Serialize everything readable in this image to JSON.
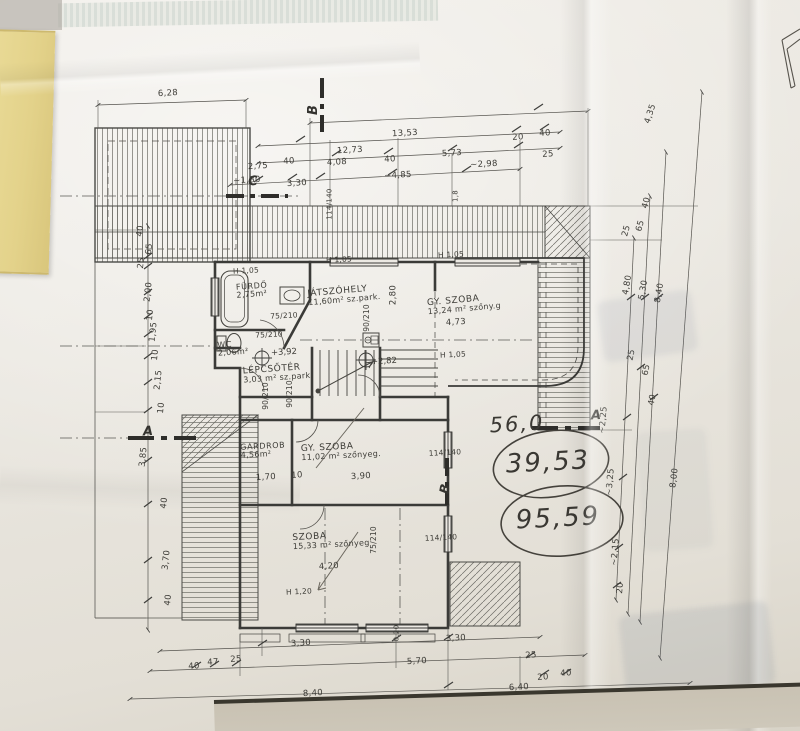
{
  "document": {
    "kind": "hand-drawn floor plan photo",
    "language": "Hungarian"
  },
  "colors": {
    "paper": "#ece9e3",
    "ink": "#3e3e3b",
    "pencil": "#55524c",
    "tape": "#e3d28b"
  },
  "plan": {
    "rooms": [
      {
        "name": "FÜRDŐ",
        "area": "2,75m²",
        "x": 252,
        "y": 291,
        "r": -4,
        "s": 8
      },
      {
        "name": "WC",
        "area": "2,06m²",
        "x": 233,
        "y": 349,
        "r": -4,
        "s": 8
      },
      {
        "name": "JÁTSZÓHELY",
        "area": "11,60m² sz.park.",
        "x": 344,
        "y": 296,
        "r": -5,
        "s": 9
      },
      {
        "name": "GY. SZOBA",
        "area": "13,24 m² szőny.g",
        "x": 464,
        "y": 305,
        "r": -5,
        "s": 9
      },
      {
        "name": "LÉPCSŐTÉR",
        "area": "3,03 m² sz.park.",
        "x": 278,
        "y": 374,
        "r": -4,
        "s": 9
      },
      {
        "name": "GARDROB",
        "area": "4,56m²",
        "x": 263,
        "y": 451,
        "r": -3,
        "s": 8
      },
      {
        "name": "GY. SZOBA",
        "area": "11,02 m² szőnyeg.",
        "x": 341,
        "y": 452,
        "r": -3,
        "s": 9
      },
      {
        "name": "SZOBA",
        "area": "15,33 m² szőnyeg",
        "x": 331,
        "y": 541,
        "r": -3,
        "s": 9
      }
    ],
    "levels": [
      {
        "t": "+3,92",
        "x": 284,
        "y": 353
      },
      {
        "t": "+2,82",
        "x": 384,
        "y": 362
      }
    ],
    "sections": [
      {
        "t": "C",
        "x": 253,
        "y": 182
      },
      {
        "t": "B",
        "x": 314,
        "y": 110,
        "r": -90
      },
      {
        "t": "A",
        "x": 148,
        "y": 432
      },
      {
        "t": "A",
        "x": 596,
        "y": 416
      },
      {
        "t": "B",
        "x": 446,
        "y": 489,
        "r": -80
      }
    ],
    "dimensions": [
      {
        "t": "6,28",
        "x": 168,
        "y": 94
      },
      {
        "t": "13,53",
        "x": 405,
        "y": 134
      },
      {
        "t": "12,73",
        "x": 350,
        "y": 151
      },
      {
        "t": "20",
        "x": 518,
        "y": 138
      },
      {
        "t": "40",
        "x": 545,
        "y": 134
      },
      {
        "t": "25",
        "x": 548,
        "y": 155
      },
      {
        "t": "5,73",
        "x": 452,
        "y": 154
      },
      {
        "t": "~2,98",
        "x": 484,
        "y": 165
      },
      {
        "t": "4,08",
        "x": 337,
        "y": 163
      },
      {
        "t": "40",
        "x": 390,
        "y": 160
      },
      {
        "t": "~4,85",
        "x": 398,
        "y": 176
      },
      {
        "t": "2,75",
        "x": 258,
        "y": 167
      },
      {
        "t": "40",
        "x": 289,
        "y": 162
      },
      {
        "t": "~1,80",
        "x": 247,
        "y": 181
      },
      {
        "t": "3,30",
        "x": 297,
        "y": 184
      },
      {
        "t": "114/140",
        "x": 330,
        "y": 204,
        "r": -90,
        "s": 7
      },
      {
        "t": "1,8",
        "x": 456,
        "y": 196,
        "r": -90,
        "s": 7
      },
      {
        "t": "40",
        "x": 141,
        "y": 231,
        "r": -84
      },
      {
        "t": "65",
        "x": 150,
        "y": 249,
        "r": -84
      },
      {
        "t": "25",
        "x": 142,
        "y": 263,
        "r": -84
      },
      {
        "t": "2,00",
        "x": 149,
        "y": 292,
        "r": -84
      },
      {
        "t": "10",
        "x": 151,
        "y": 315,
        "r": -84
      },
      {
        "t": "1,95",
        "x": 154,
        "y": 332,
        "r": -84
      },
      {
        "t": "10",
        "x": 156,
        "y": 355,
        "r": -84
      },
      {
        "t": "2,15",
        "x": 159,
        "y": 380,
        "r": -84
      },
      {
        "t": "10",
        "x": 162,
        "y": 408,
        "r": -84
      },
      {
        "t": "3,85",
        "x": 144,
        "y": 457,
        "r": -84
      },
      {
        "t": "40",
        "x": 165,
        "y": 503,
        "r": -84
      },
      {
        "t": "3,70",
        "x": 167,
        "y": 560,
        "r": -84
      },
      {
        "t": "40",
        "x": 169,
        "y": 600,
        "r": -84
      },
      {
        "t": "4,35",
        "x": 651,
        "y": 114,
        "r": -72
      },
      {
        "t": "40",
        "x": 647,
        "y": 203,
        "r": -75
      },
      {
        "t": "65",
        "x": 641,
        "y": 226,
        "r": -75
      },
      {
        "t": "25",
        "x": 627,
        "y": 231,
        "r": -75
      },
      {
        "t": "4,80",
        "x": 628,
        "y": 285,
        "r": -80
      },
      {
        "t": "5,30",
        "x": 644,
        "y": 290,
        "r": -80
      },
      {
        "t": "8,40",
        "x": 660,
        "y": 293,
        "r": -80
      },
      {
        "t": "25",
        "x": 632,
        "y": 355,
        "r": -78
      },
      {
        "t": "65",
        "x": 647,
        "y": 370,
        "r": -78
      },
      {
        "t": "40",
        "x": 653,
        "y": 400,
        "r": -78
      },
      {
        "t": "~2,25",
        "x": 604,
        "y": 420,
        "r": -85
      },
      {
        "t": "~3,25",
        "x": 611,
        "y": 482,
        "r": -85
      },
      {
        "t": "~2,15",
        "x": 616,
        "y": 552,
        "r": -85
      },
      {
        "t": "20",
        "x": 621,
        "y": 588,
        "r": -85
      },
      {
        "t": "8,00",
        "x": 675,
        "y": 478,
        "r": -83
      },
      {
        "t": "3,30",
        "x": 301,
        "y": 644
      },
      {
        "t": "0,20",
        "x": 397,
        "y": 633,
        "r": -90,
        "s": 7
      },
      {
        "t": "3,30",
        "x": 456,
        "y": 639
      },
      {
        "t": "5,70",
        "x": 417,
        "y": 662
      },
      {
        "t": "40",
        "x": 194,
        "y": 667
      },
      {
        "t": "47",
        "x": 213,
        "y": 663
      },
      {
        "t": "25",
        "x": 236,
        "y": 660
      },
      {
        "t": "25",
        "x": 531,
        "y": 656
      },
      {
        "t": "20",
        "x": 543,
        "y": 678
      },
      {
        "t": "40",
        "x": 566,
        "y": 674
      },
      {
        "t": "8,40",
        "x": 313,
        "y": 694
      },
      {
        "t": "6,40",
        "x": 519,
        "y": 688
      },
      {
        "t": "1,70",
        "x": 266,
        "y": 478
      },
      {
        "t": "10",
        "x": 297,
        "y": 476
      },
      {
        "t": "3,90",
        "x": 361,
        "y": 477
      },
      {
        "t": "4,20",
        "x": 329,
        "y": 567
      },
      {
        "t": "4,73",
        "x": 456,
        "y": 323
      },
      {
        "t": "2,80",
        "x": 394,
        "y": 295,
        "r": -90
      }
    ],
    "openings": [
      {
        "t": "H 1,05",
        "x": 246,
        "y": 271
      },
      {
        "t": "H 1,05",
        "x": 339,
        "y": 260
      },
      {
        "t": "H 1,05",
        "x": 451,
        "y": 255
      },
      {
        "t": "H 1,05",
        "x": 453,
        "y": 355
      },
      {
        "t": "H 1,20",
        "x": 299,
        "y": 592
      },
      {
        "t": "75/210",
        "x": 284,
        "y": 316
      },
      {
        "t": "75/210",
        "x": 269,
        "y": 335
      },
      {
        "t": "90/210",
        "x": 266,
        "y": 396,
        "r": -90
      },
      {
        "t": "90/210",
        "x": 290,
        "y": 394,
        "r": -90
      },
      {
        "t": "90/210",
        "x": 367,
        "y": 318,
        "r": -90
      },
      {
        "t": "75/210",
        "x": 374,
        "y": 540,
        "r": -90
      },
      {
        "t": "114/140",
        "x": 445,
        "y": 453
      },
      {
        "t": "114/140",
        "x": 441,
        "y": 538
      }
    ],
    "handwritten": [
      {
        "t": "56,0",
        "x": 517,
        "y": 424,
        "s": 21
      },
      {
        "t": "39,53",
        "x": 548,
        "y": 463,
        "s": 26
      },
      {
        "t": "95,59",
        "x": 558,
        "y": 519,
        "s": 26
      }
    ]
  }
}
